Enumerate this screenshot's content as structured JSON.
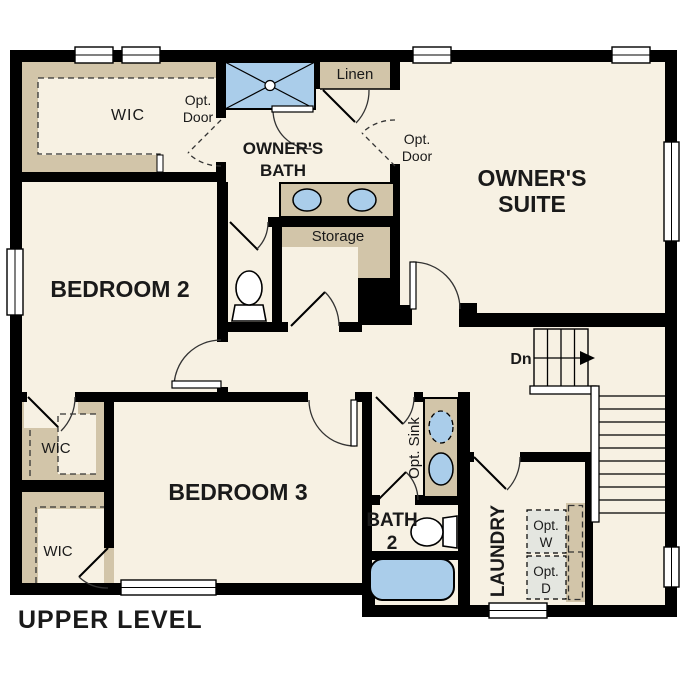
{
  "title": "UPPER LEVEL",
  "rooms": {
    "owners_suite": {
      "line1": "OWNER'S",
      "line2": "SUITE"
    },
    "owners_bath": {
      "line1": "OWNER'S",
      "line2": "BATH"
    },
    "bedroom_2": {
      "label": "BEDROOM 2"
    },
    "bedroom_3": {
      "label": "BEDROOM 3"
    },
    "bath_2": {
      "line1": "BATH",
      "line2": "2"
    },
    "laundry": {
      "label": "LAUNDRY"
    },
    "wic_owners": {
      "label": "WIC"
    },
    "wic_bedroom2": {
      "label": "WIC"
    },
    "wic_bedroom3": {
      "label": "WIC"
    },
    "linen": {
      "label": "Linen"
    },
    "storage": {
      "label": "Storage"
    }
  },
  "annotations": {
    "opt_door_wic": {
      "line1": "Opt.",
      "line2": "Door"
    },
    "opt_door_suite": {
      "line1": "Opt.",
      "line2": "Door"
    },
    "opt_sink": {
      "label": "Opt. Sink"
    },
    "opt_washer": {
      "line1": "Opt.",
      "line2": "W"
    },
    "opt_dryer": {
      "line1": "Opt.",
      "line2": "D"
    },
    "stair_direction": {
      "label": "Dn"
    }
  },
  "colors": {
    "wall": "#000000",
    "floor": "#f7f1e3",
    "closet": "#d2c5a9",
    "fixture_blue": "#aacdea",
    "opt_box": "#e4e6e0",
    "door_line": "#333333",
    "text": "#1a1a1a",
    "background": "#ffffff"
  }
}
